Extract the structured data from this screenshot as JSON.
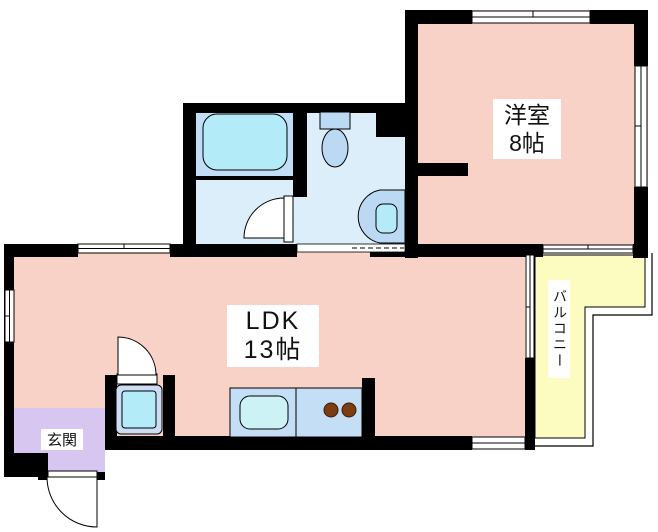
{
  "plan": {
    "type": "floor-plan",
    "rooms": {
      "western": {
        "label": "洋室",
        "size": "8帖"
      },
      "ldk": {
        "label": "LDK",
        "size": "13帖"
      },
      "genkan": {
        "label": "玄関"
      },
      "balcony": {
        "label": "バルコニー"
      }
    },
    "colors": {
      "room_pink": "#f8d2c6",
      "bath_blue": "#c2def6",
      "washroom_blue": "#ddeefb",
      "toilet_blue": "#ddeefb",
      "fixture_blue": "#bcd9f3",
      "fixture_cyan": "#b3ecf8",
      "sink_cyan": "#cdf2f6",
      "counter_blue": "#c4def6",
      "washer_frame_blue": "#ccdcf4",
      "genkan_purple": "#d7c6ef",
      "balcony_yellow": "#fcfbc0",
      "wall": "#000000",
      "burner_brown": "#7c3d12",
      "burner_edge": "#3a1c06",
      "outside": "#ffffff"
    },
    "fixtures": {
      "bathtub": "bathtub-icon",
      "toilet": "toilet-icon",
      "washbasin": "washbasin-icon",
      "washing_machine": "washing-machine-pan-icon",
      "kitchen_sink": "kitchen-sink-icon",
      "stove": "stove-burners-icon"
    }
  }
}
